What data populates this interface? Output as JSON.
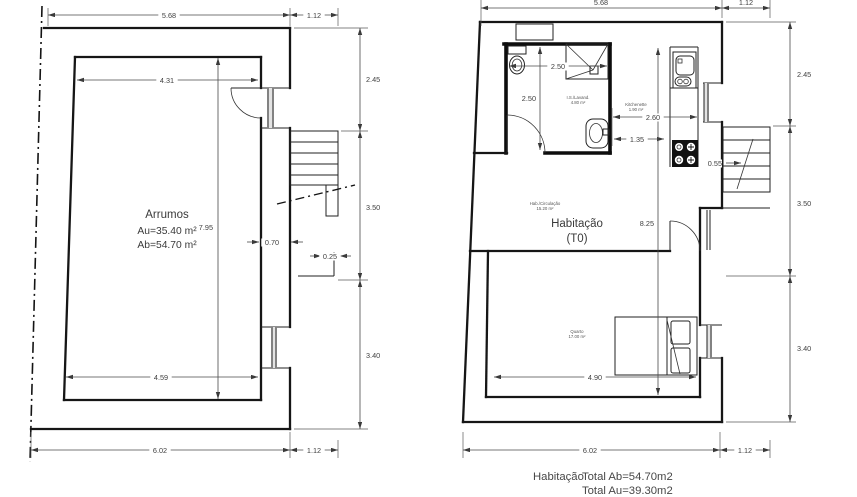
{
  "drawing": {
    "left_plan": {
      "room_label": "Arrumos",
      "area_line1": "Au=35.40 m²",
      "area_line2": "Ab=54.70 m²",
      "dims": [
        {
          "text": "5.68",
          "x": 169,
          "y": 18,
          "bg": true
        },
        {
          "text": "1.12",
          "x": 314,
          "y": 18,
          "bg": true
        },
        {
          "text": "2.45",
          "x": 366,
          "y": 82,
          "anchor": "start"
        },
        {
          "text": "3.50",
          "x": 366,
          "y": 210,
          "anchor": "start"
        },
        {
          "text": "3.40",
          "x": 366,
          "y": 358,
          "anchor": "start"
        },
        {
          "text": "4.31",
          "x": 167,
          "y": 83,
          "bg": true
        },
        {
          "text": "7.95",
          "x": 213,
          "y": 230,
          "anchor": "end"
        },
        {
          "text": "4.59",
          "x": 161,
          "y": 380,
          "bg": true
        },
        {
          "text": "0.70",
          "x": 272,
          "y": 245,
          "bg": true
        },
        {
          "text": "0.25",
          "x": 330,
          "y": 259,
          "bg": true
        },
        {
          "text": "6.02",
          "x": 160,
          "y": 453,
          "bg": true
        },
        {
          "text": "1.12",
          "x": 314,
          "y": 453,
          "bg": true
        }
      ]
    },
    "right_plan": {
      "room_label_line1": "Habitação",
      "room_label_line2": "(T0)",
      "small_labels": [
        {
          "text": "I.S./Lavand.",
          "x": 578,
          "y": 99
        },
        {
          "text": "4.80 m²",
          "x": 578,
          "y": 104
        },
        {
          "text": "Kitchenette",
          "x": 636,
          "y": 106
        },
        {
          "text": "1.90 m²",
          "x": 636,
          "y": 111
        },
        {
          "text": "Hab./Circulação",
          "x": 545,
          "y": 205
        },
        {
          "text": "15.20 m²",
          "x": 545,
          "y": 210
        },
        {
          "text": "Quarto",
          "x": 577,
          "y": 333
        },
        {
          "text": "17.00 m²",
          "x": 577,
          "y": 338
        }
      ],
      "dims": [
        {
          "text": "5.68",
          "x": 601,
          "y": 5,
          "bg": true
        },
        {
          "text": "1.12",
          "x": 746,
          "y": 5,
          "bg": true
        },
        {
          "text": "2.45",
          "x": 797,
          "y": 77,
          "anchor": "start"
        },
        {
          "text": "3.50",
          "x": 797,
          "y": 206,
          "anchor": "start"
        },
        {
          "text": "3.40",
          "x": 797,
          "y": 351,
          "anchor": "start"
        },
        {
          "text": "2.50",
          "x": 558,
          "y": 69,
          "bg": true
        },
        {
          "text": "2.50",
          "x": 536,
          "y": 101,
          "anchor": "end"
        },
        {
          "text": "2.60",
          "x": 653,
          "y": 120,
          "bg": true
        },
        {
          "text": "1.35",
          "x": 637,
          "y": 142,
          "bg": true
        },
        {
          "text": "8.25",
          "x": 654,
          "y": 226,
          "anchor": "end"
        },
        {
          "text": "0.55",
          "x": 722,
          "y": 166,
          "anchor": "end",
          "bg": true
        },
        {
          "text": "4.90",
          "x": 595,
          "y": 380,
          "bg": true
        },
        {
          "text": "6.02",
          "x": 590,
          "y": 453,
          "bg": true
        },
        {
          "text": "1.12",
          "x": 745,
          "y": 453,
          "bg": true
        }
      ]
    },
    "footer": {
      "room": "Habitação",
      "total_ab": "Total Ab=54.70m2",
      "total_au": "Total Au=39.30m2"
    }
  }
}
